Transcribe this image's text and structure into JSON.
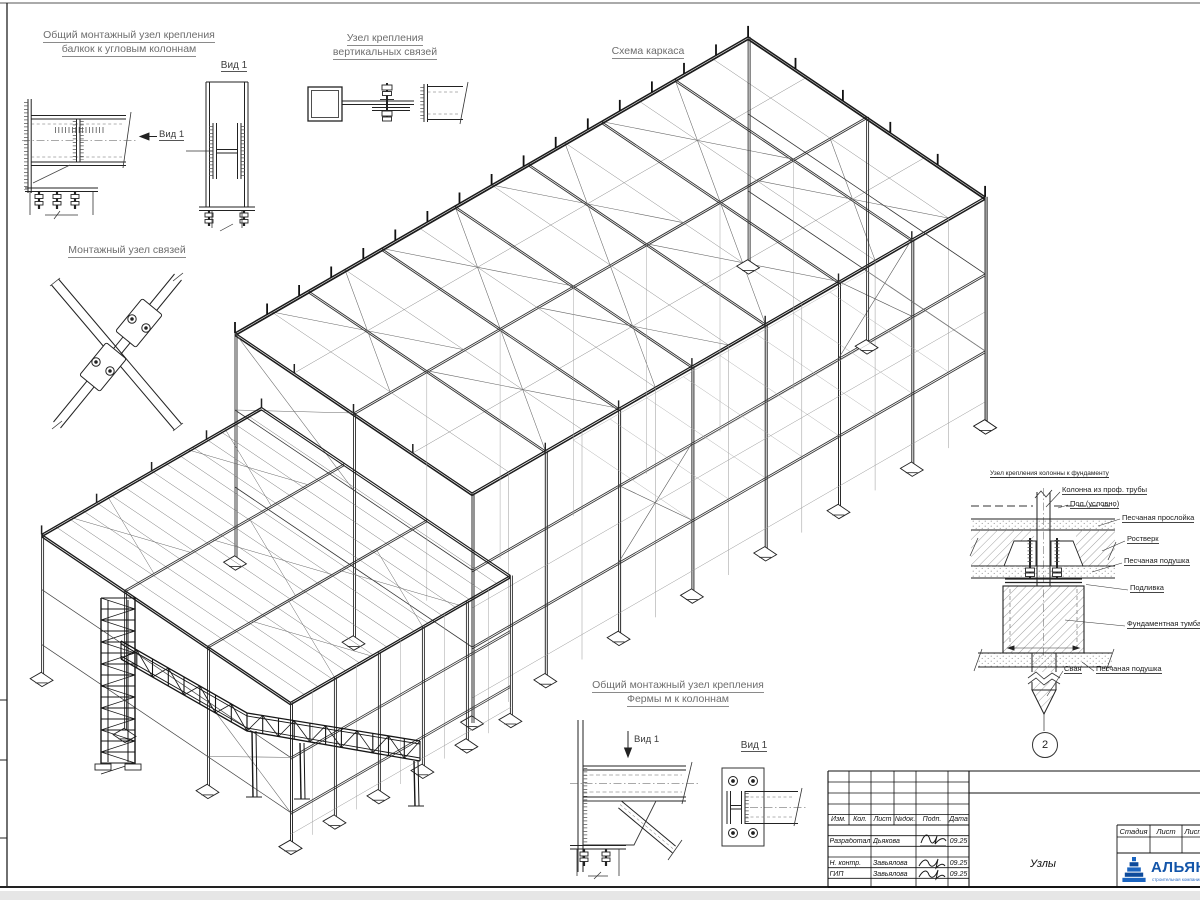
{
  "sheet": {
    "outside_color": "#e6e6e6",
    "paper_color": "#ffffff",
    "line_color": "#2b2b2b"
  },
  "scheme": {
    "title": "Схема каркаса"
  },
  "details": {
    "corner_beam": {
      "title_line1": "Общий монтажный узел крепления",
      "title_line2": "балкок к угловым колоннам",
      "view_arrow_label": "Вид 1",
      "view_title": "Вид 1"
    },
    "vertical_brace": {
      "title_line1": "Узел крепления",
      "title_line2": "вертикальных связей"
    },
    "brace_node": {
      "title": "Монтажный узел связей"
    },
    "truss_column": {
      "title_line1": "Общий монтажный узел крепления",
      "title_line2": "Фермы м к колоннам",
      "view_arrow_label": "Вид 1",
      "view_title": "Вид 1"
    },
    "foundation": {
      "title": "Узел крепления колонны к фундаменту",
      "labels": {
        "column": "Колонна из проф. трубы",
        "floor": "Пол (условно)",
        "sand_layer": "Песчаная прослойка",
        "grillage": "Ростверк",
        "sand_cushion_1": "Песчаная подушка",
        "grout": "Подливка",
        "foundation_block": "Фундаментная тумба",
        "pile": "Свая",
        "sand_cushion_2": "Песчаная подушка"
      },
      "marker": "2"
    }
  },
  "titleblock": {
    "rev_headers": [
      "Изм.",
      "Кол.",
      "Лист",
      "№док.",
      "Подп.",
      "Дата"
    ],
    "rows": [
      {
        "role": "Разработал",
        "name": "Дьякова",
        "date": "09.25"
      },
      {
        "role": "Н. контр.",
        "name": "Завьялова",
        "date": "09.25"
      },
      {
        "role": "ГИП",
        "name": "Завьялова",
        "date": "09.25"
      }
    ],
    "doc_title": "Узлы",
    "stage_headers": [
      "Стадия",
      "Лист",
      "Листов"
    ],
    "company": {
      "name": "АЛЬЯНС",
      "tagline": "строительная компания",
      "logo_color": "#1355a9"
    }
  }
}
